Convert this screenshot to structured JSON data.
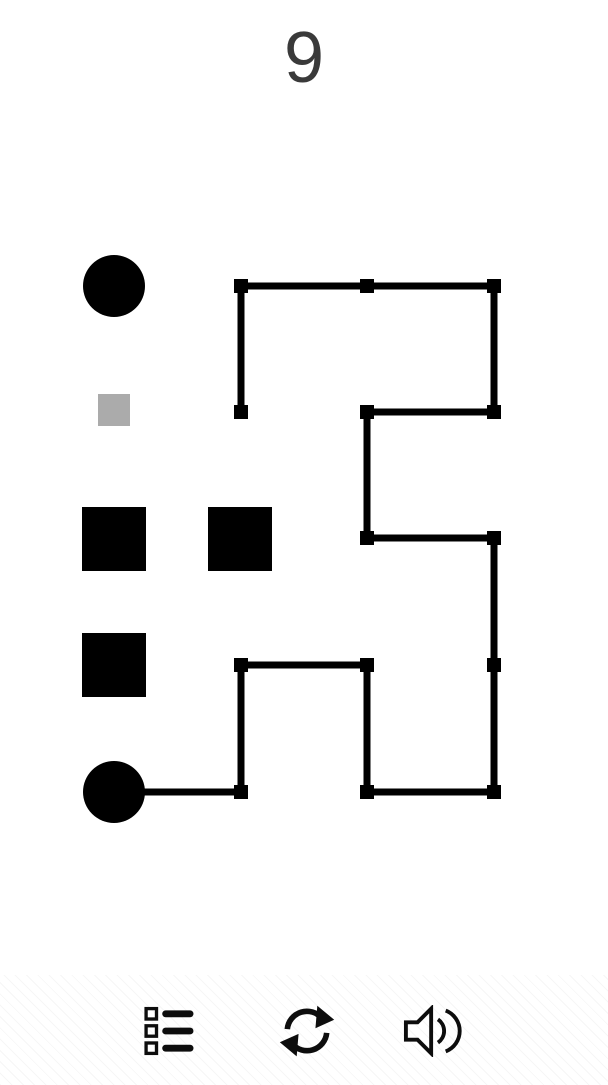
{
  "level": {
    "number": "9"
  },
  "colors": {
    "background": "#ffffff",
    "ink": "#000000",
    "icon_ink": "#0d0d0d",
    "gray_square": "#ababab",
    "level_text": "#3a3a3a"
  },
  "puzzle": {
    "grid": {
      "cols": [
        114,
        241,
        367,
        494
      ],
      "rows": [
        286,
        412,
        538,
        665,
        792
      ]
    },
    "shapes": [
      {
        "name": "start-dot-top-left",
        "type": "circle",
        "cx": 114,
        "cy": 286,
        "r": 31,
        "color": "#000000",
        "interactable": "true"
      },
      {
        "name": "hint-gray-square",
        "type": "rect",
        "x": 98,
        "y": 394,
        "w": 32,
        "h": 32,
        "color": "#ababab",
        "interactable": "false"
      },
      {
        "name": "block-square-1",
        "type": "rect",
        "x": 82,
        "y": 507,
        "w": 64,
        "h": 64,
        "color": "#000000",
        "interactable": "false"
      },
      {
        "name": "block-square-2",
        "type": "rect",
        "x": 208,
        "y": 507,
        "w": 64,
        "h": 64,
        "color": "#000000",
        "interactable": "false"
      },
      {
        "name": "block-square-3",
        "type": "rect",
        "x": 82,
        "y": 633,
        "w": 64,
        "h": 64,
        "color": "#000000",
        "interactable": "false"
      },
      {
        "name": "start-dot-bottom-left",
        "type": "circle",
        "cx": 114,
        "cy": 792,
        "r": 31,
        "color": "#000000",
        "interactable": "true"
      }
    ],
    "path": {
      "stroke_width": 7,
      "node_size": 14,
      "nodes": [
        [
          241,
          286
        ],
        [
          367,
          286
        ],
        [
          494,
          286
        ],
        [
          241,
          412
        ],
        [
          367,
          412
        ],
        [
          494,
          412
        ],
        [
          367,
          538
        ],
        [
          494,
          538
        ],
        [
          241,
          665
        ],
        [
          367,
          665
        ],
        [
          494,
          665
        ],
        [
          241,
          792
        ],
        [
          367,
          792
        ],
        [
          494,
          792
        ]
      ],
      "segments": [
        [
          241,
          286,
          494,
          286
        ],
        [
          241,
          286,
          241,
          412
        ],
        [
          494,
          286,
          494,
          412
        ],
        [
          367,
          412,
          494,
          412
        ],
        [
          367,
          412,
          367,
          538
        ],
        [
          367,
          538,
          494,
          538
        ],
        [
          494,
          538,
          494,
          792
        ],
        [
          241,
          665,
          367,
          665
        ],
        [
          241,
          665,
          241,
          792
        ],
        [
          367,
          665,
          367,
          792
        ],
        [
          114,
          792,
          241,
          792
        ],
        [
          367,
          792,
          494,
          792
        ]
      ]
    }
  },
  "toolbar": {
    "buttons": [
      {
        "name": "levels-button",
        "icon": "list-icon"
      },
      {
        "name": "restart-button",
        "icon": "refresh-icon"
      },
      {
        "name": "sound-button",
        "icon": "speaker-icon"
      }
    ]
  }
}
